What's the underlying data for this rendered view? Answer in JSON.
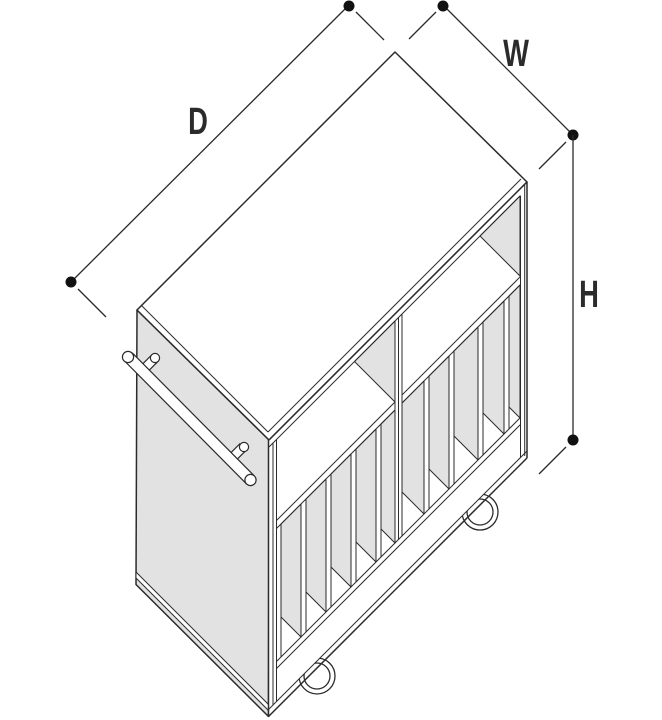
{
  "diagram": {
    "title": "Isometric dimension diagram of a divided storage cart with casters",
    "labels": {
      "depth": "D",
      "width": "W",
      "height": "H"
    },
    "colors": {
      "line": "#2b2b2b",
      "panel": "#e2e2e2",
      "background": "#ffffff",
      "marker": "#111111"
    }
  }
}
